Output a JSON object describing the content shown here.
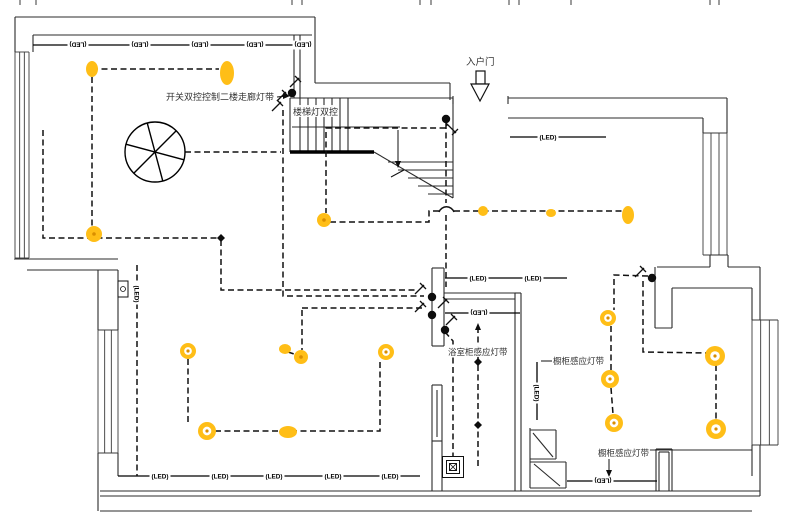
{
  "canvas": {
    "w": 786,
    "h": 520,
    "bg": "#ffffff",
    "ink": "#111111",
    "wall": "#2b2b2b",
    "win": "#3a3a3a",
    "yellow": "#FFBE17",
    "yellow_dark": "#D98E00",
    "label_color": "#333333"
  },
  "led_text": "(LED)",
  "labels": [
    {
      "id": "corridor-switch-note",
      "text": "开关双控控制二楼走廊灯带",
      "x": 166,
      "y": 100,
      "size": 9,
      "bg": false
    },
    {
      "id": "stair-light-note",
      "text": "楼梯灯双控",
      "x": 293,
      "y": 115,
      "size": 9,
      "bg": true
    },
    {
      "id": "entry-door-label",
      "text": "入户门",
      "x": 466,
      "y": 65,
      "size": 9.5,
      "bg": false
    },
    {
      "id": "bath-cabinet-sensor-note",
      "text": "浴室柜感应灯带",
      "x": 448,
      "y": 355,
      "size": 8.5,
      "bg": true
    },
    {
      "id": "cabinet-sensor-note-1",
      "text": "橱柜感应灯带",
      "x": 553,
      "y": 364,
      "size": 8.5,
      "bg": false
    },
    {
      "id": "cabinet-sensor-note-2",
      "text": "橱柜感应灯带",
      "x": 598,
      "y": 456,
      "size": 8.5,
      "bg": true
    }
  ],
  "led_markers": [
    {
      "x": 78,
      "y": 45,
      "rot": 180
    },
    {
      "x": 140,
      "y": 45,
      "rot": 180
    },
    {
      "x": 200,
      "y": 45,
      "rot": 180
    },
    {
      "x": 255,
      "y": 45,
      "rot": 180
    },
    {
      "x": 303,
      "y": 45,
      "rot": 180
    },
    {
      "x": 548,
      "y": 137,
      "rot": 0
    },
    {
      "x": 478,
      "y": 278,
      "rot": 0
    },
    {
      "x": 533,
      "y": 278,
      "rot": 0
    },
    {
      "x": 479,
      "y": 313,
      "rot": 180
    },
    {
      "x": 160,
      "y": 476,
      "rot": 0
    },
    {
      "x": 220,
      "y": 476,
      "rot": 0
    },
    {
      "x": 274,
      "y": 476,
      "rot": 0
    },
    {
      "x": 333,
      "y": 476,
      "rot": 0
    },
    {
      "x": 390,
      "y": 476,
      "rot": 0
    },
    {
      "x": 603,
      "y": 481,
      "rot": 180
    },
    {
      "x": 537,
      "y": 393,
      "rot": 90
    },
    {
      "x": 137,
      "y": 294,
      "rot": 90
    }
  ],
  "strips": [
    [
      [
        33,
        45
      ],
      [
        313,
        45
      ]
    ],
    [
      [
        510,
        137
      ],
      [
        606,
        137
      ]
    ],
    [
      [
        445,
        278
      ],
      [
        567,
        278
      ]
    ],
    [
      [
        445,
        313
      ],
      [
        520,
        313
      ]
    ],
    [
      [
        118,
        476
      ],
      [
        420,
        476
      ]
    ],
    [
      [
        567,
        481
      ],
      [
        657,
        481
      ]
    ],
    [
      [
        537,
        362
      ],
      [
        537,
        420
      ]
    ]
  ],
  "walls": [
    [
      [
        15,
        17
      ],
      [
        315,
        17
      ]
    ],
    [
      [
        15,
        17
      ],
      [
        15,
        52
      ]
    ],
    [
      [
        33,
        35
      ],
      [
        312,
        35
      ]
    ],
    [
      [
        33,
        35
      ],
      [
        33,
        52
      ]
    ],
    [
      [
        315,
        17
      ],
      [
        315,
        83
      ]
    ],
    [
      [
        294,
        35
      ],
      [
        294,
        98
      ]
    ],
    [
      [
        300,
        35
      ],
      [
        300,
        98
      ]
    ],
    [
      [
        315,
        83
      ],
      [
        450,
        83
      ]
    ],
    [
      [
        450,
        83
      ],
      [
        450,
        100
      ]
    ],
    [
      [
        453,
        96
      ],
      [
        453,
        104
      ]
    ],
    [
      [
        508,
        96
      ],
      [
        508,
        104
      ]
    ],
    [
      [
        508,
        98
      ],
      [
        727,
        98
      ]
    ],
    [
      [
        508,
        118
      ],
      [
        703,
        118
      ]
    ],
    [
      [
        703,
        118
      ],
      [
        703,
        133
      ]
    ],
    [
      [
        727,
        98
      ],
      [
        727,
        133
      ]
    ],
    [
      [
        14,
        259
      ],
      [
        118,
        259
      ]
    ],
    [
      [
        27,
        270
      ],
      [
        118,
        270
      ]
    ],
    [
      [
        98,
        270
      ],
      [
        98,
        330
      ]
    ],
    [
      [
        118,
        270
      ],
      [
        118,
        330
      ]
    ],
    [
      [
        98,
        453
      ],
      [
        98,
        511
      ]
    ],
    [
      [
        118,
        453
      ],
      [
        118,
        476
      ]
    ],
    [
      [
        100,
        491
      ],
      [
        760,
        491
      ]
    ],
    [
      [
        100,
        496
      ],
      [
        760,
        496
      ]
    ],
    [
      [
        100,
        511
      ],
      [
        752,
        511
      ]
    ],
    [
      [
        432,
        268
      ],
      [
        444,
        268
      ]
    ],
    [
      [
        432,
        268
      ],
      [
        432,
        346
      ]
    ],
    [
      [
        444,
        268
      ],
      [
        444,
        346
      ]
    ],
    [
      [
        432,
        346
      ],
      [
        444,
        346
      ]
    ],
    [
      [
        444,
        293
      ],
      [
        515,
        293
      ]
    ],
    [
      [
        444,
        299
      ],
      [
        515,
        299
      ]
    ],
    [
      [
        515,
        293
      ],
      [
        515,
        491
      ]
    ],
    [
      [
        521,
        293
      ],
      [
        521,
        491
      ]
    ],
    [
      [
        515,
        293
      ],
      [
        521,
        293
      ]
    ],
    [
      [
        432,
        385
      ],
      [
        442,
        385
      ]
    ],
    [
      [
        432,
        385
      ],
      [
        432,
        491
      ]
    ],
    [
      [
        442,
        385
      ],
      [
        442,
        491
      ]
    ],
    [
      [
        432,
        441
      ],
      [
        442,
        441
      ]
    ],
    [
      [
        437,
        390
      ],
      [
        437,
        437
      ]
    ],
    [
      [
        647,
        450
      ],
      [
        752,
        450
      ]
    ],
    [
      [
        656,
        449
      ],
      [
        672,
        449
      ]
    ],
    [
      [
        656,
        449
      ],
      [
        656,
        491
      ]
    ],
    [
      [
        672,
        449
      ],
      [
        672,
        491
      ]
    ],
    [
      [
        659,
        452
      ],
      [
        659,
        491
      ]
    ],
    [
      [
        669,
        452
      ],
      [
        669,
        491
      ]
    ],
    [
      [
        659,
        452
      ],
      [
        669,
        452
      ]
    ],
    [
      [
        657,
        267
      ],
      [
        710,
        267
      ]
    ],
    [
      [
        710,
        255
      ],
      [
        728,
        255
      ]
    ],
    [
      [
        710,
        255
      ],
      [
        710,
        267
      ]
    ],
    [
      [
        728,
        255
      ],
      [
        728,
        267
      ]
    ],
    [
      [
        728,
        267
      ],
      [
        760,
        267
      ]
    ],
    [
      [
        760,
        267
      ],
      [
        760,
        320
      ]
    ],
    [
      [
        760,
        445
      ],
      [
        760,
        496
      ]
    ],
    [
      [
        672,
        288
      ],
      [
        752,
        288
      ]
    ],
    [
      [
        752,
        288
      ],
      [
        752,
        320
      ]
    ],
    [
      [
        752,
        445
      ],
      [
        752,
        476
      ]
    ],
    [
      [
        655,
        267
      ],
      [
        655,
        328
      ]
    ],
    [
      [
        672,
        288
      ],
      [
        672,
        328
      ]
    ],
    [
      [
        655,
        328
      ],
      [
        672,
        328
      ]
    ],
    [
      [
        530,
        428
      ],
      [
        530,
        488
      ]
    ],
    [
      [
        530,
        430
      ],
      [
        556,
        430
      ]
    ],
    [
      [
        556,
        430
      ],
      [
        556,
        459
      ]
    ],
    [
      [
        533,
        433
      ],
      [
        553,
        457
      ]
    ],
    [
      [
        530,
        459
      ],
      [
        556,
        459
      ]
    ],
    [
      [
        530,
        462
      ],
      [
        566,
        462
      ]
    ],
    [
      [
        566,
        462
      ],
      [
        566,
        488
      ]
    ],
    [
      [
        530,
        488
      ],
      [
        566,
        488
      ]
    ],
    [
      [
        534,
        464
      ],
      [
        560,
        486
      ]
    ],
    [
      [
        290,
        98
      ],
      [
        453,
        98
      ]
    ],
    [
      [
        290,
        98
      ],
      [
        290,
        152
      ]
    ],
    [
      [
        453,
        98
      ],
      [
        453,
        198
      ]
    ],
    [
      [
        374,
        152
      ],
      [
        453,
        198
      ]
    ],
    [
      [
        300,
        98
      ],
      [
        300,
        152
      ]
    ],
    [
      [
        308,
        98
      ],
      [
        308,
        152
      ]
    ],
    [
      [
        316,
        98
      ],
      [
        316,
        152
      ]
    ],
    [
      [
        324,
        98
      ],
      [
        324,
        152
      ]
    ],
    [
      [
        332,
        98
      ],
      [
        332,
        152
      ]
    ],
    [
      [
        340,
        98
      ],
      [
        340,
        152
      ]
    ],
    [
      [
        348,
        98
      ],
      [
        348,
        152
      ]
    ],
    [
      [
        292,
        127
      ],
      [
        400,
        127
      ]
    ],
    [
      [
        388,
        162
      ],
      [
        453,
        162
      ]
    ],
    [
      [
        398,
        170
      ],
      [
        453,
        170
      ]
    ],
    [
      [
        408,
        178
      ],
      [
        453,
        178
      ]
    ],
    [
      [
        418,
        186
      ],
      [
        453,
        186
      ]
    ],
    [
      [
        428,
        194
      ],
      [
        453,
        194
      ]
    ]
  ],
  "thick_walls": [
    [
      [
        290,
        152
      ],
      [
        374,
        152
      ]
    ]
  ],
  "misc_lines": [
    [
      [
        277,
        97
      ],
      [
        287,
        96
      ]
    ],
    [
      [
        398,
        130
      ],
      [
        398,
        164
      ]
    ],
    [
      [
        391,
        177
      ],
      [
        404,
        170
      ]
    ],
    [
      [
        541,
        361
      ],
      [
        552,
        361
      ]
    ],
    [
      [
        609,
        459
      ],
      [
        609,
        473
      ]
    ]
  ],
  "windows": [
    {
      "x1": 15,
      "x2": 29,
      "y1": 52,
      "y2": 258
    },
    {
      "x1": 98,
      "x2": 118,
      "y1": 330,
      "y2": 453
    },
    {
      "x1": 703,
      "x2": 727,
      "y1": 133,
      "y2": 255
    },
    {
      "x1": 752,
      "x2": 778,
      "y1": 320,
      "y2": 445
    }
  ],
  "wires": [
    [
      [
        92,
        69
      ],
      [
        219,
        69
      ]
    ],
    [
      [
        92,
        77
      ],
      [
        92,
        236
      ]
    ],
    [
      [
        43,
        130
      ],
      [
        43,
        238
      ],
      [
        218,
        238
      ]
    ],
    [
      [
        221,
        240
      ],
      [
        221,
        290
      ],
      [
        418,
        290
      ]
    ],
    [
      [
        283,
        110
      ],
      [
        283,
        296
      ],
      [
        424,
        296
      ]
    ],
    [
      [
        185,
        152
      ],
      [
        281,
        152
      ]
    ],
    [
      [
        446,
        123
      ],
      [
        446,
        203
      ]
    ],
    [
      [
        446,
        215
      ],
      [
        446,
        287
      ]
    ],
    [
      [
        446,
        120
      ],
      [
        447,
        128
      ],
      [
        326,
        128
      ],
      [
        326,
        213
      ]
    ],
    [
      [
        330,
        222
      ],
      [
        429,
        222
      ],
      [
        429,
        211
      ],
      [
        439,
        211
      ]
    ],
    [
      [
        454,
        211
      ],
      [
        628,
        211
      ]
    ],
    [
      [
        302,
        308
      ],
      [
        424,
        308
      ]
    ],
    [
      [
        302,
        310
      ],
      [
        302,
        350
      ]
    ],
    [
      [
        188,
        359
      ],
      [
        188,
        422
      ]
    ],
    [
      [
        215,
        431
      ],
      [
        380,
        431
      ],
      [
        380,
        359
      ]
    ],
    [
      [
        288,
        352
      ],
      [
        297,
        355
      ]
    ],
    [
      [
        445,
        332
      ],
      [
        453,
        341
      ],
      [
        453,
        457
      ]
    ],
    [
      [
        478,
        327
      ],
      [
        478,
        467
      ]
    ],
    [
      [
        643,
        281
      ],
      [
        643,
        352
      ],
      [
        706,
        353
      ]
    ],
    [
      [
        716,
        365
      ],
      [
        716,
        419
      ]
    ],
    [
      [
        648,
        276
      ],
      [
        614,
        275
      ],
      [
        614,
        310
      ]
    ],
    [
      [
        611,
        326
      ],
      [
        611,
        370
      ]
    ],
    [
      [
        611,
        388
      ],
      [
        613,
        414
      ]
    ],
    [
      [
        137,
        265
      ],
      [
        137,
        476
      ]
    ]
  ],
  "hop": "M439,212 a8 8 0 0 1 15 0",
  "lights": [
    {
      "t": "blob",
      "x": 92,
      "y": 69,
      "rx": 6,
      "ry": 8
    },
    {
      "t": "blob",
      "x": 227,
      "y": 73,
      "rx": 7,
      "ry": 12
    },
    {
      "t": "spot",
      "x": 94,
      "y": 234,
      "r": 8
    },
    {
      "t": "spot",
      "x": 324,
      "y": 220,
      "r": 7
    },
    {
      "t": "blob",
      "x": 483,
      "y": 211,
      "rx": 5,
      "ry": 5
    },
    {
      "t": "blob",
      "x": 551,
      "y": 213,
      "rx": 5,
      "ry": 4
    },
    {
      "t": "blob",
      "x": 628,
      "y": 215,
      "rx": 6,
      "ry": 9
    },
    {
      "t": "blob",
      "x": 285,
      "y": 349,
      "rx": 6,
      "ry": 5
    },
    {
      "t": "spot",
      "x": 301,
      "y": 357,
      "r": 7
    },
    {
      "t": "ring",
      "x": 386,
      "y": 352,
      "r": 8
    },
    {
      "t": "ring",
      "x": 188,
      "y": 351,
      "r": 8
    },
    {
      "t": "ring",
      "x": 207,
      "y": 431,
      "r": 9
    },
    {
      "t": "blob",
      "x": 288,
      "y": 432,
      "rx": 9,
      "ry": 6
    },
    {
      "t": "ring",
      "x": 608,
      "y": 318,
      "r": 8
    },
    {
      "t": "ring",
      "x": 610,
      "y": 379,
      "r": 9
    },
    {
      "t": "ring",
      "x": 614,
      "y": 423,
      "r": 9
    },
    {
      "t": "ring",
      "x": 715,
      "y": 356,
      "r": 10
    },
    {
      "t": "ring",
      "x": 716,
      "y": 429,
      "r": 10
    }
  ],
  "dots": [
    [
      292,
      93
    ],
    [
      446,
      119
    ],
    [
      432,
      297
    ],
    [
      432,
      315
    ],
    [
      445,
      330
    ],
    [
      652,
      278
    ]
  ],
  "diamonds": [
    [
      221,
      238
    ],
    [
      478,
      362
    ],
    [
      478,
      425
    ]
  ],
  "switches": [
    [
      295,
      82,
      0
    ],
    [
      282,
      96,
      0
    ],
    [
      277,
      106,
      0
    ],
    [
      452,
      129,
      90
    ],
    [
      420,
      289,
      0
    ],
    [
      420,
      307,
      0
    ],
    [
      443,
      303,
      0
    ],
    [
      451,
      320,
      0
    ],
    [
      640,
      272,
      0
    ]
  ],
  "arrows": [
    {
      "x": 478,
      "y": 323,
      "dir": "up"
    },
    {
      "x": 609,
      "y": 477,
      "dir": "down"
    },
    {
      "x": 290,
      "y": 96,
      "dir": "right"
    },
    {
      "x": 398,
      "y": 168,
      "dir": "down"
    }
  ],
  "fan": {
    "cx": 155,
    "cy": 152,
    "r": 30,
    "angles": [
      15,
      75,
      135
    ]
  },
  "door": {
    "rect": [
      476,
      71,
      9,
      13
    ],
    "tri": [
      [
        471,
        84
      ],
      [
        489,
        84
      ],
      [
        480,
        101
      ]
    ]
  },
  "spotlight": {
    "cx": 453,
    "cy": 467,
    "sizes": [
      21,
      13,
      7
    ]
  },
  "fixture": {
    "rect": [
      118,
      281,
      10,
      16
    ],
    "circle": [
      123,
      289,
      2.5
    ]
  },
  "ticks": [
    20,
    36,
    292,
    302,
    420,
    431,
    509,
    519,
    571,
    710,
    719
  ]
}
